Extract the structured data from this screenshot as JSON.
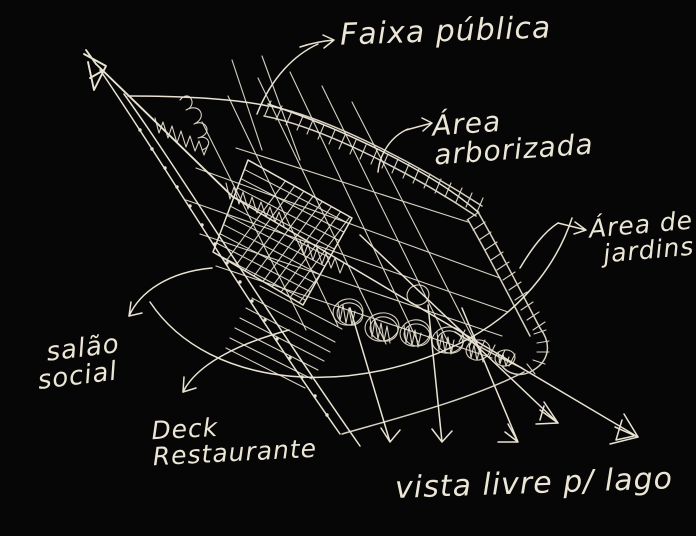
{
  "canvas": {
    "background_color": "#060606",
    "ink_color": "#e9e3d3"
  },
  "labels": {
    "faixa_publica": "Faixa pública",
    "area_arborizada_line1": "Área",
    "area_arborizada_line2": "arborizada",
    "area_jardins_line1": "Área de",
    "area_jardins_line2": "jardins",
    "salao_line1": "salão",
    "salao_line2": "social",
    "deck_line1": "Deck",
    "deck_line2": "Restaurante",
    "vista_livre": "vista livre p/ lago"
  }
}
